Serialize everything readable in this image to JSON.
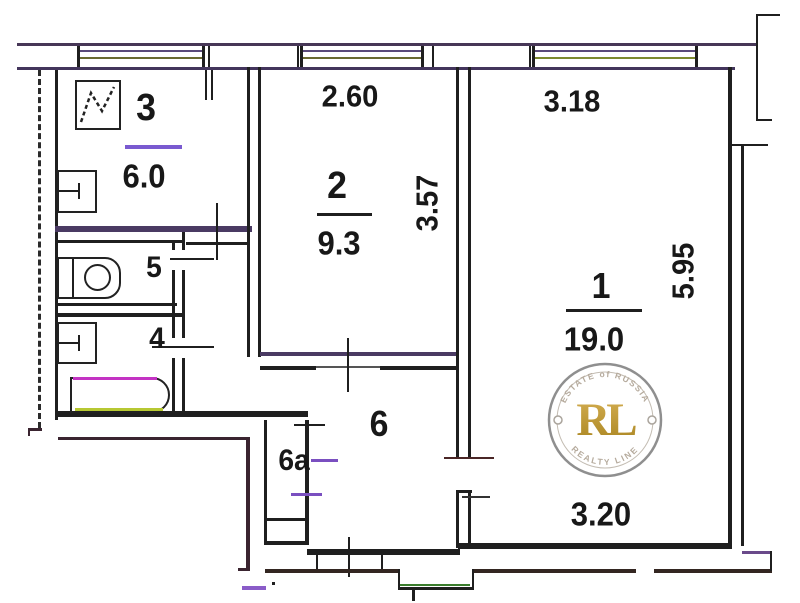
{
  "rooms": {
    "r1": {
      "number": "1",
      "area": "19.0"
    },
    "r2": {
      "number": "2",
      "area": "9.3"
    },
    "r3": {
      "number": "3",
      "area": "6.0"
    },
    "r4": {
      "number": "4"
    },
    "r5": {
      "number": "5"
    },
    "r6": {
      "number": "6"
    },
    "r6a": {
      "number": "6a"
    }
  },
  "dims": {
    "w260": "2.60",
    "w318": "3.18",
    "h357": "3.57",
    "h595": "5.95",
    "w320": "3.20"
  },
  "watermark": {
    "initials": "RL",
    "arc_top": "ESTATE of RUSSIA",
    "arc_bottom": "REALTY LINE"
  },
  "colors": {
    "line": "#1f1f1f",
    "purple_wall": "#4a3a63",
    "window_purple": "#5a4a7a",
    "window_olive": "#7d8a2e",
    "gold": "#c79b35",
    "porch_green": "#3a7d2c"
  }
}
